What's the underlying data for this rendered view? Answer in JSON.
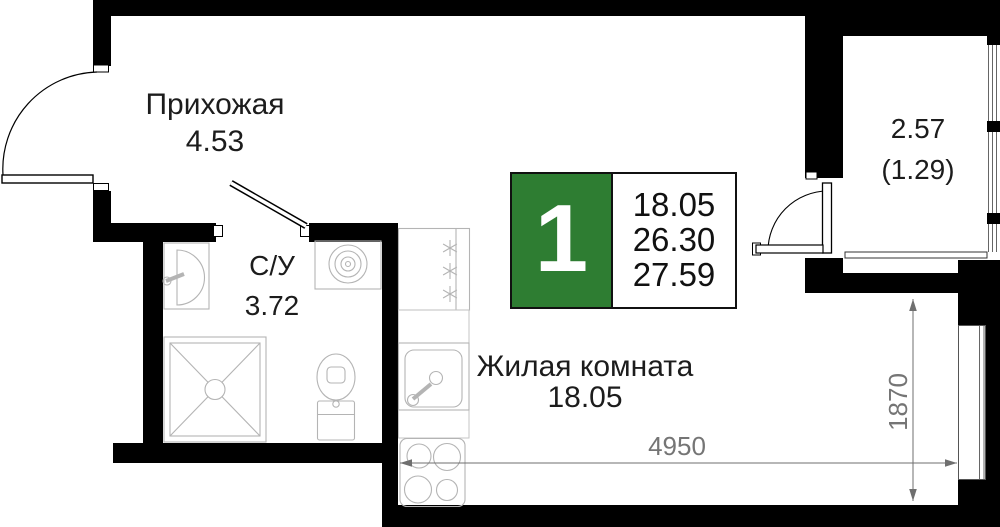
{
  "colors": {
    "accent_green": "#2E7D32",
    "wall_black": "#000000",
    "dimension_gray": "#757575",
    "fixture_gray": "#B4B4B4"
  },
  "rooms": {
    "hallway": {
      "label": "Прихожая",
      "area": "4.53"
    },
    "bathroom": {
      "label": "С/У",
      "area": "3.72"
    },
    "living_room": {
      "label": "Жилая комната",
      "area": "18.05"
    },
    "balcony": {
      "area": "2.57",
      "area_coefficient": "(1.29)"
    }
  },
  "info_badge": {
    "rooms_count": "1",
    "living_area": "18.05",
    "area_without_summer": "26.30",
    "total_area": "27.59"
  },
  "dimensions": {
    "width": "4950",
    "depth": "1870"
  }
}
